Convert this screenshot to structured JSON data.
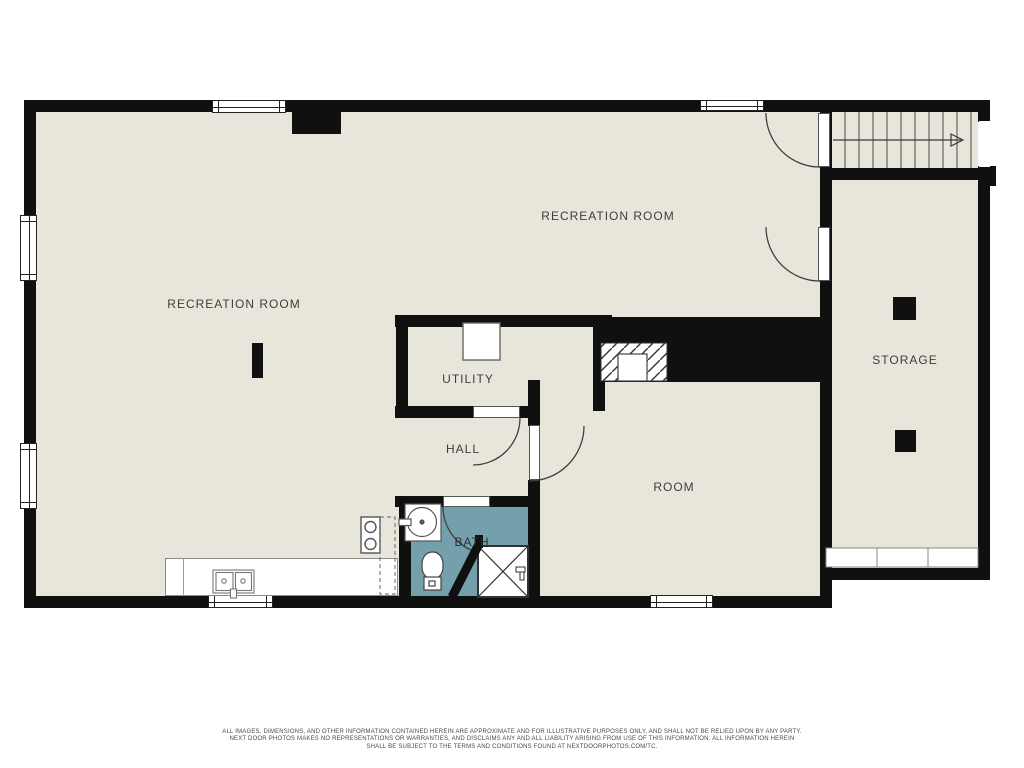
{
  "plan": {
    "labels": {
      "recreation_room_top": "RECREATION ROOM",
      "recreation_room_left": "RECREATION ROOM",
      "utility": "UTILITY",
      "hall": "HALL",
      "bath": "BATH",
      "room": "ROOM",
      "storage": "STORAGE"
    },
    "icons": {
      "stair_direction": "arrow-right"
    }
  },
  "colors": {
    "wall": "#101010",
    "floor": "#e8e6da",
    "bath_floor": "#74a0ac",
    "background": "#ffffff",
    "line": "#3f3f3f",
    "label_text": "#3d3d3d"
  },
  "footer": {
    "line1": "ALL IMAGES, DIMENSIONS, AND OTHER INFORMATION CONTAINED HEREIN ARE APPROXIMATE AND FOR ILLUSTRATIVE PURPOSES ONLY, AND SHALL NOT BE RELIED UPON BY ANY PARTY.",
    "line2": "NEXT DOOR PHOTOS MAKES NO REPRESENTATIONS OR WARRANTIES, AND DISCLAIMS ANY AND ALL LIABILITY ARISING FROM USE OF THIS INFORMATION. ALL INFORMATION HEREIN",
    "line3": "SHALL BE SUBJECT TO THE TERMS AND CONDITIONS FOUND AT NEXTDOORPHOTOS.COM/TC."
  }
}
